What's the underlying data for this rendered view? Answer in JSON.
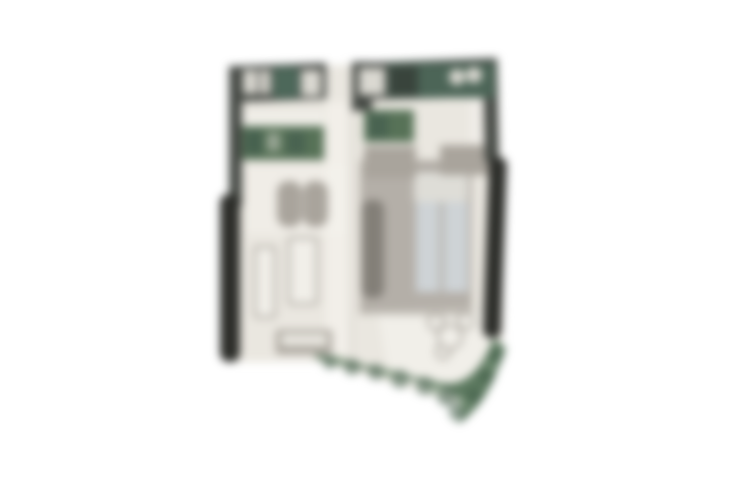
{
  "meta": {
    "description": "Blurred top-down architectural floor plan of an apartment unit with terrace and landscaping, centered on a white background",
    "canvas_width": 750,
    "canvas_height": 500
  },
  "colors": {
    "background": "#ffffff",
    "floor": "#eae7e0",
    "floor_light": "#f4f2ec",
    "wall": "#454944",
    "wall_dark": "#2d2e2a",
    "fixture_green": "#577257",
    "fixture_green_dark": "#3f5a4c",
    "fixture_green_deep": "#4d685a",
    "fixture_light": "#dad8d1",
    "furniture_gray": "#a9a49c",
    "furniture_light": "#f1efe9",
    "counter_gray": "#837f78",
    "bed_area_gray": "#b4afa8",
    "pillow": "#deddd7",
    "bed_linen_blue": "#ced3d6",
    "shrub_green": "#5d7a60",
    "shrub_green_dark": "#455f4b",
    "shrub_green_light": "#87a186",
    "outline": "#9a958d",
    "line_gray": "#d6d3cb"
  },
  "elements": [
    "exterior-walls",
    "bathroom-fixtures",
    "kitchen-counter",
    "wardrobe-green-cabinet",
    "double-bed",
    "armchair-pair",
    "coffee-table",
    "side-table",
    "sofa-bench",
    "bistro-table-set",
    "balcony-wall-left",
    "balcony-wall-right",
    "terrace",
    "shrub-band"
  ]
}
